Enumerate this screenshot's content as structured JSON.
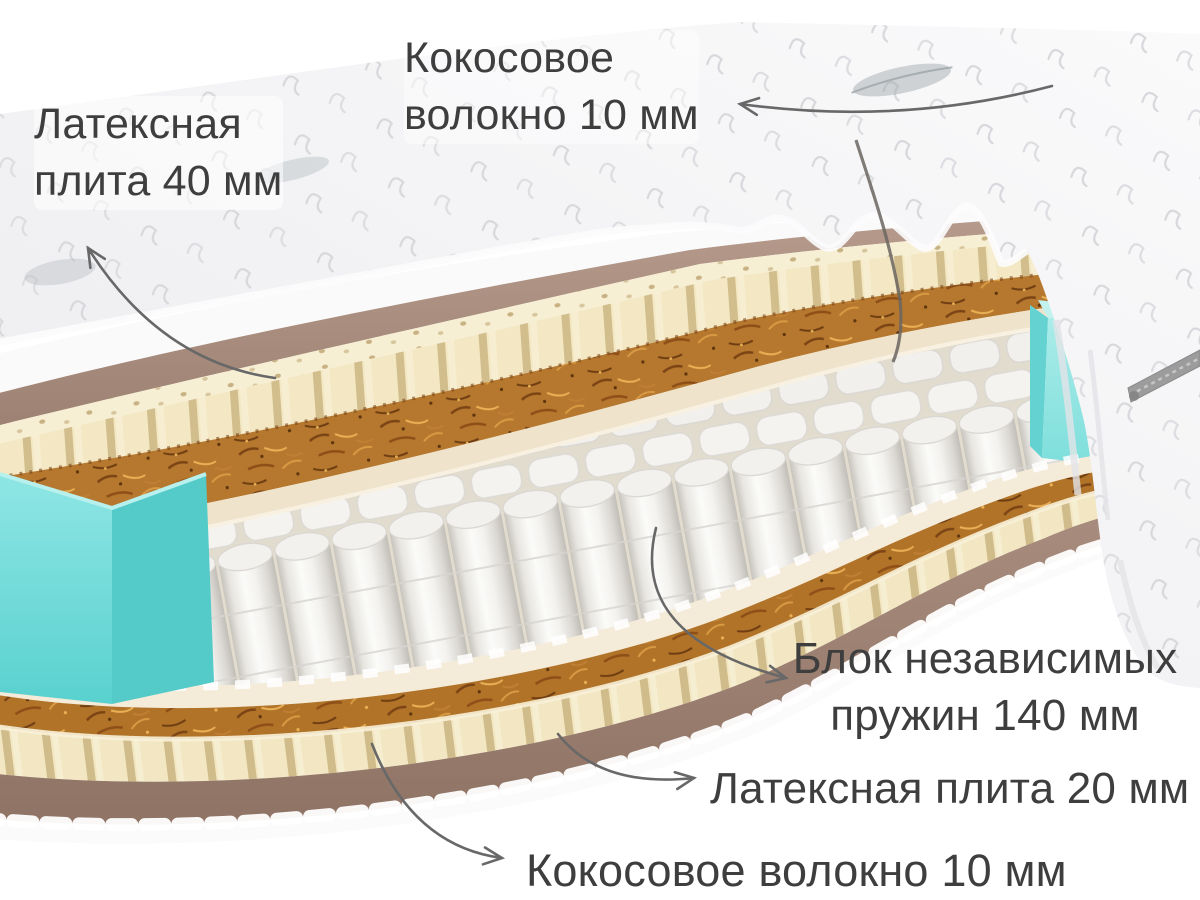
{
  "illustration": {
    "type": "mattress-cutaway",
    "background": "#ffffff",
    "text_color": "#3e3e3e",
    "arrow_color": "#666666",
    "layer_colors": {
      "cover": "#f2f2f4",
      "latex": "#f3e8c3",
      "coconut_fiber": "#b5782e",
      "spring_block": "#f4f3f0",
      "side_foam": "#7ddedd",
      "base": "#ab9083"
    },
    "labels": {
      "latex_top": {
        "line1": "Латексная",
        "line2": "плита 40 мм"
      },
      "coconut_top": {
        "line1": "Кокосовое",
        "line2": "волокно 10 мм"
      },
      "spring_block": {
        "line1": "Блок независимых",
        "line2": "пружин 140 мм"
      },
      "latex_bottom": {
        "text": "Латексная плита 20 мм"
      },
      "coconut_bottom": {
        "text": "Кокосовое волокно 10 мм"
      }
    }
  }
}
